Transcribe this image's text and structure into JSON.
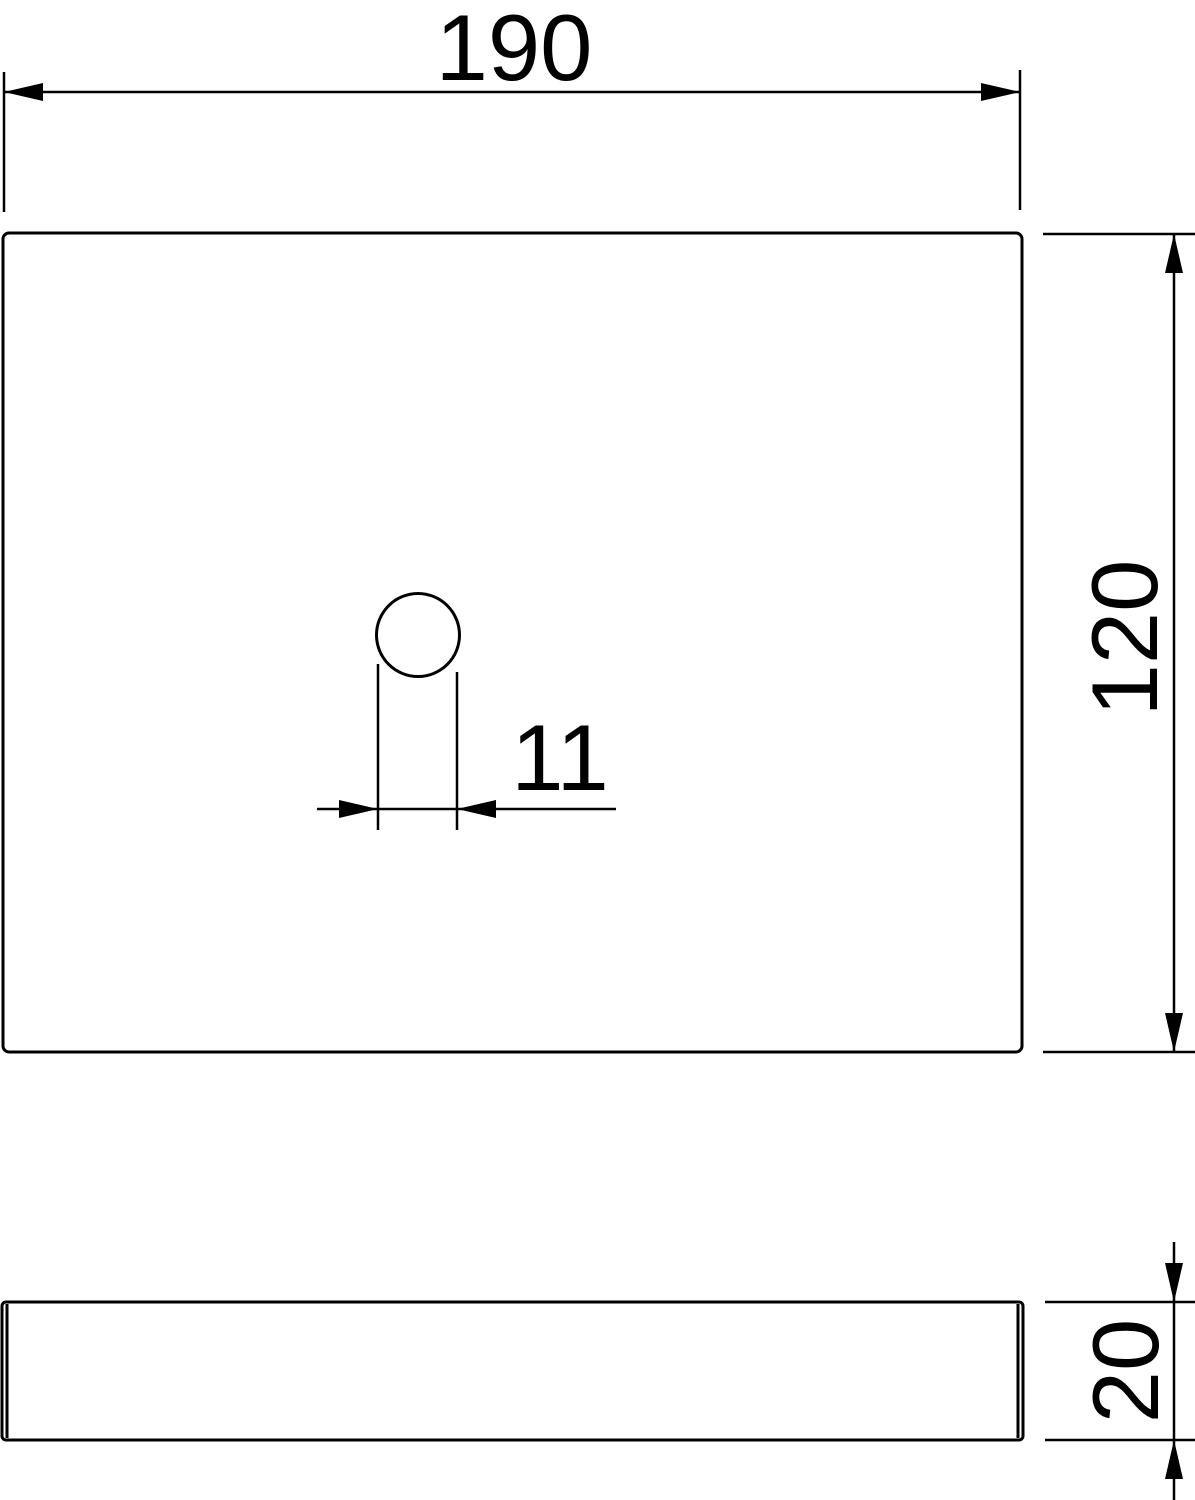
{
  "drawing": {
    "background_color": "#ffffff",
    "line_color": "#000000",
    "text_color": "#000000",
    "views": {
      "top_view": "plate with hole",
      "side_view": "plate thickness profile"
    },
    "dimensions": {
      "width": {
        "value": "190"
      },
      "height": {
        "value": "120"
      },
      "hole_offset": {
        "value": "11"
      },
      "thickness": {
        "value": "20"
      }
    }
  }
}
